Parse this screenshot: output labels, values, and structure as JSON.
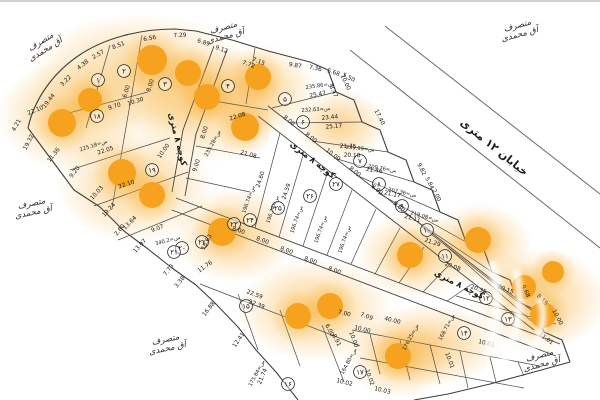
{
  "map": {
    "street_label": "خیابان ۱۲ متری",
    "alley_label": "کوچه ۸ متری",
    "occupant": {
      "line1": "متصرف",
      "line2": "آق محمدی"
    },
    "colors": {
      "dot": "#F6A21E",
      "glow": "#F7A823",
      "line": "#3f3f3f",
      "interior_line": "#4a4a4a",
      "street_line": "#6a6a6a",
      "text": "#161616"
    },
    "plots": [
      {
        "n": "۱",
        "x": 98,
        "y": 80
      },
      {
        "n": "۲",
        "x": 124,
        "y": 71
      },
      {
        "n": "۳",
        "x": 165,
        "y": 84
      },
      {
        "n": "۴",
        "x": 228,
        "y": 86
      },
      {
        "n": "۵",
        "x": 285,
        "y": 99
      },
      {
        "n": "۶",
        "x": 303,
        "y": 122
      },
      {
        "n": "۷",
        "x": 360,
        "y": 161
      },
      {
        "n": "۸",
        "x": 379,
        "y": 184
      },
      {
        "n": "۹",
        "x": 402,
        "y": 206
      },
      {
        "n": "۱۰",
        "x": 427,
        "y": 230
      },
      {
        "n": "۱۱",
        "x": 445,
        "y": 256
      },
      {
        "n": "۱۲",
        "x": 486,
        "y": 298
      },
      {
        "n": "۱۳",
        "x": 508,
        "y": 319
      },
      {
        "n": "۱۴",
        "x": 464,
        "y": 333
      },
      {
        "n": "۱۵",
        "x": 246,
        "y": 306
      },
      {
        "n": "۱۶",
        "x": 288,
        "y": 384
      },
      {
        "n": "۱۷",
        "x": 360,
        "y": 372
      },
      {
        "n": "۱۸",
        "x": 97,
        "y": 116
      },
      {
        "n": "۱۹",
        "x": 152,
        "y": 170
      },
      {
        "n": "۲۰",
        "x": 182,
        "y": 248
      },
      {
        "n": "۲۱",
        "x": 174,
        "y": 252
      },
      {
        "n": "۲۲",
        "x": 202,
        "y": 242
      },
      {
        "n": "۲۳",
        "x": 234,
        "y": 224
      },
      {
        "n": "۲۴",
        "x": 250,
        "y": 220
      },
      {
        "n": "۲۵",
        "x": 278,
        "y": 208
      },
      {
        "n": "۲۶",
        "x": 310,
        "y": 196
      },
      {
        "n": "۲۷",
        "x": 336,
        "y": 184
      }
    ],
    "dots": [
      {
        "x": 152,
        "y": 60,
        "r": 15
      },
      {
        "x": 188,
        "y": 73,
        "r": 13
      },
      {
        "x": 62,
        "y": 123,
        "r": 14
      },
      {
        "x": 207,
        "y": 97,
        "r": 13
      },
      {
        "x": 258,
        "y": 77,
        "r": 13
      },
      {
        "x": 245,
        "y": 127,
        "r": 14
      },
      {
        "x": 90,
        "y": 100,
        "r": 12
      },
      {
        "x": 122,
        "y": 173,
        "r": 14
      },
      {
        "x": 152,
        "y": 195,
        "r": 13
      },
      {
        "x": 222,
        "y": 232,
        "r": 14
      },
      {
        "x": 298,
        "y": 316,
        "r": 13
      },
      {
        "x": 330,
        "y": 306,
        "r": 13
      },
      {
        "x": 398,
        "y": 356,
        "r": 13
      },
      {
        "x": 410,
        "y": 255,
        "r": 13
      },
      {
        "x": 478,
        "y": 240,
        "r": 13
      },
      {
        "x": 524,
        "y": 287,
        "r": 12
      },
      {
        "x": 543,
        "y": 315,
        "r": 13
      },
      {
        "x": 553,
        "y": 272,
        "r": 11
      }
    ],
    "glows": [
      {
        "x": 140,
        "y": 75,
        "rx": 110,
        "ry": 62
      },
      {
        "x": 70,
        "y": 115,
        "rx": 72,
        "ry": 56
      },
      {
        "x": 205,
        "y": 105,
        "rx": 78,
        "ry": 58
      },
      {
        "x": 135,
        "y": 185,
        "rx": 78,
        "ry": 58
      },
      {
        "x": 235,
        "y": 235,
        "rx": 62,
        "ry": 48
      },
      {
        "x": 255,
        "y": 90,
        "rx": 62,
        "ry": 46
      },
      {
        "x": 315,
        "y": 310,
        "rx": 78,
        "ry": 52
      },
      {
        "x": 415,
        "y": 255,
        "rx": 58,
        "ry": 44
      },
      {
        "x": 480,
        "y": 245,
        "rx": 52,
        "ry": 42
      },
      {
        "x": 540,
        "y": 300,
        "rx": 68,
        "ry": 52
      },
      {
        "x": 400,
        "y": 358,
        "rx": 52,
        "ry": 40
      },
      {
        "x": 340,
        "y": 125,
        "rx": 46,
        "ry": 36
      },
      {
        "x": 430,
        "y": 345,
        "rx": 72,
        "ry": 42
      }
    ],
    "dims": [
      {
        "t": "19.44",
        "x": 50,
        "y": 102,
        "r": -52
      },
      {
        "t": "3.22",
        "x": 67,
        "y": 82,
        "r": -45
      },
      {
        "t": "4.38",
        "x": 84,
        "y": 66,
        "r": -38
      },
      {
        "t": "2.57",
        "x": 99,
        "y": 56,
        "r": -30
      },
      {
        "t": "8.51",
        "x": 119,
        "y": 47,
        "r": -20
      },
      {
        "t": "6.56",
        "x": 150,
        "y": 40,
        "r": -10
      },
      {
        "t": "7.29",
        "x": 180,
        "y": 37,
        "r": -2
      },
      {
        "t": "6.89",
        "x": 203,
        "y": 44,
        "r": 18
      },
      {
        "t": "9.12",
        "x": 221,
        "y": 51,
        "r": 20
      },
      {
        "t": "7.15",
        "x": 258,
        "y": 63,
        "r": 22
      },
      {
        "t": "9.87",
        "x": 295,
        "y": 67,
        "r": 10
      },
      {
        "t": "7.36",
        "x": 315,
        "y": 70,
        "r": 12
      },
      {
        "t": "5.68",
        "x": 333,
        "y": 74,
        "r": 18
      },
      {
        "t": "5.50",
        "x": 348,
        "y": 79,
        "r": 28
      },
      {
        "t": "10.00",
        "x": 344,
        "y": 83,
        "r": 65
      },
      {
        "t": "8.47",
        "x": 332,
        "y": 92,
        "r": 65
      },
      {
        "t": "17.40",
        "x": 378,
        "y": 118,
        "r": 62
      },
      {
        "t": "9.82",
        "x": 420,
        "y": 170,
        "r": 62
      },
      {
        "t": "5.84",
        "x": 428,
        "y": 184,
        "r": 62
      },
      {
        "t": "2.00",
        "x": 435,
        "y": 196,
        "r": 62
      },
      {
        "t": "9.68",
        "x": 524,
        "y": 292,
        "r": 62
      },
      {
        "t": "8.15",
        "x": 541,
        "y": 301,
        "r": 45
      },
      {
        "t": "20.15",
        "x": 505,
        "y": 291,
        "r": 20
      },
      {
        "t": "10.00",
        "x": 556,
        "y": 318,
        "r": 62
      },
      {
        "t": "25.47",
        "x": 318,
        "y": 96,
        "r": -10
      },
      {
        "t": "23.44",
        "x": 330,
        "y": 119,
        "r": -5
      },
      {
        "t": "25.17",
        "x": 334,
        "y": 128,
        "r": -5
      },
      {
        "t": "21.75",
        "x": 348,
        "y": 148,
        "r": 2
      },
      {
        "t": "20.18",
        "x": 352,
        "y": 157,
        "r": 2
      },
      {
        "t": "21.46",
        "x": 374,
        "y": 172,
        "r": 8
      },
      {
        "t": "21.17",
        "x": 392,
        "y": 196,
        "r": 12
      },
      {
        "t": "21.11",
        "x": 412,
        "y": 220,
        "r": 16
      },
      {
        "t": "21.29",
        "x": 432,
        "y": 244,
        "r": 18
      },
      {
        "t": "20.08",
        "x": 452,
        "y": 268,
        "r": 20
      },
      {
        "t": "20.35",
        "x": 478,
        "y": 291,
        "r": 20
      },
      {
        "t": "8.00",
        "x": 288,
        "y": 122,
        "r": 38
      },
      {
        "t": "8.00",
        "x": 310,
        "y": 139,
        "r": 38
      },
      {
        "t": "10.00",
        "x": 332,
        "y": 156,
        "r": 38
      },
      {
        "t": "8.00",
        "x": 354,
        "y": 173,
        "r": 38
      },
      {
        "t": "8.00",
        "x": 376,
        "y": 191,
        "r": 38
      },
      {
        "t": "9.80",
        "x": 398,
        "y": 208,
        "r": 38
      },
      {
        "t": "8.00",
        "x": 206,
        "y": 133,
        "r": -72
      },
      {
        "t": "9.00",
        "x": 198,
        "y": 166,
        "r": -72
      },
      {
        "t": "10.00",
        "x": 165,
        "y": 152,
        "r": -55
      },
      {
        "t": "9.70",
        "x": 115,
        "y": 108,
        "r": -18
      },
      {
        "t": "10.30",
        "x": 136,
        "y": 103,
        "r": -18
      },
      {
        "t": "22.10",
        "x": 36,
        "y": 112,
        "r": -22
      },
      {
        "t": "22.05",
        "x": 106,
        "y": 152,
        "r": -18
      },
      {
        "t": "22.10",
        "x": 127,
        "y": 186,
        "r": -18
      },
      {
        "t": "6.00",
        "x": 128,
        "y": 92,
        "r": -72
      },
      {
        "t": "8.00",
        "x": 152,
        "y": 86,
        "r": -72
      },
      {
        "t": "7.72",
        "x": 248,
        "y": 66,
        "r": 20
      },
      {
        "t": "22.08",
        "x": 238,
        "y": 118,
        "r": -18
      },
      {
        "t": "21.08",
        "x": 248,
        "y": 156,
        "r": 16
      },
      {
        "t": "18.63",
        "x": 208,
        "y": 243,
        "r": -62
      },
      {
        "t": "11.76",
        "x": 206,
        "y": 268,
        "r": -35
      },
      {
        "t": "4.21",
        "x": 18,
        "y": 126,
        "r": -60
      },
      {
        "t": "19.32",
        "x": 30,
        "y": 143,
        "r": -62
      },
      {
        "t": "11.36",
        "x": 55,
        "y": 156,
        "r": -52
      },
      {
        "t": "9.20",
        "x": 76,
        "y": 173,
        "r": -52
      },
      {
        "t": "10.03",
        "x": 98,
        "y": 194,
        "r": -48
      },
      {
        "t": "19.24",
        "x": 110,
        "y": 211,
        "r": -48
      },
      {
        "t": "13.64",
        "x": 131,
        "y": 224,
        "r": -45
      },
      {
        "t": "2.80",
        "x": 121,
        "y": 231,
        "r": -50
      },
      {
        "t": "13.97",
        "x": 141,
        "y": 247,
        "r": -48
      },
      {
        "t": "7.73",
        "x": 170,
        "y": 271,
        "r": -52
      },
      {
        "t": "3.38",
        "x": 181,
        "y": 283,
        "r": -52
      },
      {
        "t": "16.88",
        "x": 210,
        "y": 310,
        "r": -52
      },
      {
        "t": "12.41",
        "x": 240,
        "y": 341,
        "r": -55
      },
      {
        "t": "21.74",
        "x": 264,
        "y": 377,
        "r": -68
      },
      {
        "t": "9.07",
        "x": 158,
        "y": 230,
        "r": -20
      },
      {
        "t": "24.60",
        "x": 262,
        "y": 180,
        "r": -72
      },
      {
        "t": "24.59",
        "x": 288,
        "y": 192,
        "r": -72
      },
      {
        "t": "8.00",
        "x": 238,
        "y": 232,
        "r": 20
      },
      {
        "t": "8.00",
        "x": 262,
        "y": 242,
        "r": 20
      },
      {
        "t": "8.00",
        "x": 286,
        "y": 252,
        "r": 20
      },
      {
        "t": "8.00",
        "x": 310,
        "y": 262,
        "r": 20
      },
      {
        "t": "8.00",
        "x": 334,
        "y": 272,
        "r": 20
      },
      {
        "t": "22.59",
        "x": 254,
        "y": 296,
        "r": 20
      },
      {
        "t": "22.39",
        "x": 256,
        "y": 306,
        "r": 20
      },
      {
        "t": "6.00",
        "x": 328,
        "y": 331,
        "r": 62
      },
      {
        "t": "8.91",
        "x": 335,
        "y": 341,
        "r": 62
      },
      {
        "t": "7.09",
        "x": 366,
        "y": 318,
        "r": 20
      },
      {
        "t": "7.00",
        "x": 344,
        "y": 315,
        "r": 14
      },
      {
        "t": "40.00",
        "x": 392,
        "y": 322,
        "r": 14
      },
      {
        "t": "10.00",
        "x": 362,
        "y": 331,
        "r": 14
      },
      {
        "t": "10.00",
        "x": 352,
        "y": 340,
        "r": 70
      },
      {
        "t": "10.01",
        "x": 486,
        "y": 345,
        "r": 14
      },
      {
        "t": "10.01",
        "x": 448,
        "y": 361,
        "r": 70
      },
      {
        "t": "10.02",
        "x": 344,
        "y": 384,
        "r": 14
      },
      {
        "t": "10.02",
        "x": 368,
        "y": 378,
        "r": 70
      },
      {
        "t": "10.03",
        "x": 382,
        "y": 392,
        "r": 14
      },
      {
        "t": "11.01",
        "x": 545,
        "y": 340,
        "r": 35
      }
    ],
    "areas": [
      {
        "t": "س=235.86",
        "x": 320,
        "y": 87,
        "r": -8
      },
      {
        "t": "س=232.63",
        "x": 316,
        "y": 111,
        "r": -4
      },
      {
        "t": "س=235.99",
        "x": 360,
        "y": 150,
        "r": 6
      },
      {
        "t": "س=209.76",
        "x": 382,
        "y": 170,
        "r": 10
      },
      {
        "t": "س=207.36",
        "x": 402,
        "y": 194,
        "r": 12
      },
      {
        "t": "س=219.08",
        "x": 424,
        "y": 218,
        "r": 16
      },
      {
        "t": "س=225.18",
        "x": 94,
        "y": 147,
        "r": -18
      },
      {
        "t": "س=235.28",
        "x": 214,
        "y": 144,
        "r": -62
      },
      {
        "t": "س=340.2",
        "x": 168,
        "y": 242,
        "r": -15
      },
      {
        "t": "س=196.74",
        "x": 250,
        "y": 200,
        "r": -70
      },
      {
        "t": "س=196.74",
        "x": 274,
        "y": 210,
        "r": -70
      },
      {
        "t": "س=196.74",
        "x": 298,
        "y": 220,
        "r": -70
      },
      {
        "t": "س=196.74",
        "x": 322,
        "y": 230,
        "r": -70
      },
      {
        "t": "س=196.74",
        "x": 346,
        "y": 240,
        "r": -70
      },
      {
        "t": "س=175.84",
        "x": 258,
        "y": 374,
        "r": -62
      },
      {
        "t": "س=164.80",
        "x": 350,
        "y": 362,
        "r": -62
      },
      {
        "t": "س=176.25",
        "x": 412,
        "y": 338,
        "r": -62
      },
      {
        "t": "س=168.71",
        "x": 448,
        "y": 328,
        "r": -62
      }
    ],
    "occupants": [
      {
        "x": 42,
        "y": 44,
        "r": -32
      },
      {
        "x": 224,
        "y": 30,
        "r": -15
      },
      {
        "x": 518,
        "y": 28,
        "r": -15
      },
      {
        "x": 32,
        "y": 206,
        "r": -12
      },
      {
        "x": 166,
        "y": 342,
        "r": -12
      },
      {
        "x": 540,
        "y": 358,
        "r": -15
      }
    ],
    "alley_labels": [
      {
        "x": 175,
        "y": 140,
        "r": 76
      },
      {
        "x": 311,
        "y": 162,
        "r": 38
      },
      {
        "x": 458,
        "y": 287,
        "r": 27
      }
    ],
    "street_label_pos": {
      "x": 492,
      "y": 150,
      "r": 39
    }
  }
}
